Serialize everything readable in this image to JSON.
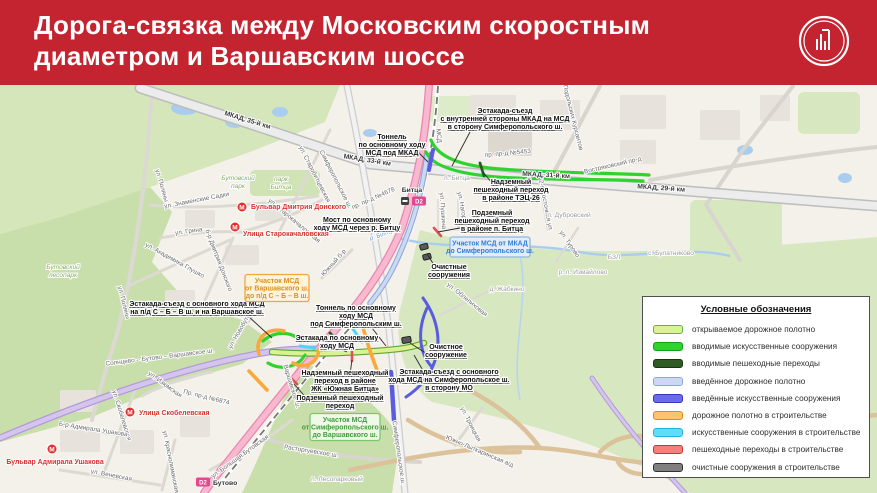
{
  "header": {
    "line1": "Дорога-связка между Московским скоростным",
    "line2": "диаметром и Варшавским шоссе",
    "bg_color": "#c32430",
    "logo": "moscow-construction-complex-logo"
  },
  "legend": {
    "title": "Условные обозначения",
    "items": [
      {
        "label": "открываемое дорожное полотно",
        "fill": "#dcf193",
        "border": "#6ab42d"
      },
      {
        "label": "вводимые искусственные сооружения",
        "fill": "#2ed32e",
        "border": "#14a014"
      },
      {
        "label": "вводимые пешеходные переходы",
        "fill": "#2e5b24",
        "border": "#17350f"
      },
      {
        "label": "введённое дорожное полотно",
        "fill": "#ccd9f2",
        "border": "#8ba6d9"
      },
      {
        "label": "введённые искусственные сооружения",
        "fill": "#6b6bea",
        "border": "#3737bb"
      },
      {
        "label": "дорожное полотно в строительстве",
        "fill": "#fdc46d",
        "border": "#e08a1e"
      },
      {
        "label": "искусственные сооружения в строительстве",
        "fill": "#63dcfb",
        "border": "#1fb4dd"
      },
      {
        "label": "пешеходные переходы в строительстве",
        "fill": "#f57e7e",
        "border": "#cc3333"
      },
      {
        "label": "очистные сооружения в строительстве",
        "fill": "#808080",
        "border": "#333333"
      }
    ]
  },
  "map": {
    "callouts": [
      {
        "ls": [
          "Эстакада-съезд",
          "с внутренней стороны МКАД на МСД",
          "в сторону Симферопольского ш."
        ],
        "x": 505,
        "y": 113,
        "lx": 470,
        "ly": 132,
        "tx": 452,
        "ty": 166
      },
      {
        "ls": [
          "Тоннель",
          "по основному ходу",
          "МСД под МКАД"
        ],
        "x": 392,
        "y": 139,
        "lx": 418,
        "ly": 152,
        "tx": 428,
        "ty": 162
      },
      {
        "ls": [
          "Надземный",
          "пешеходный переход",
          "в районе ТЭЦ-26"
        ],
        "x": 511,
        "y": 184,
        "lx": 492,
        "ly": 183,
        "tx": 483,
        "ty": 172
      },
      {
        "ls": [
          "Мост по основному",
          "ходу МСД через р. Битцу"
        ],
        "x": 357,
        "y": 222,
        "lx": 388,
        "ly": 228,
        "tx": 399,
        "ty": 232
      },
      {
        "ls": [
          "Подземный",
          "пешеходный переход",
          "в районе п. Битца"
        ],
        "x": 492,
        "y": 215,
        "lx": 460,
        "ly": 228,
        "tx": 438,
        "ty": 232
      },
      {
        "ls": [
          "Очистные",
          "сооружения"
        ],
        "x": 449,
        "y": 269,
        "lx": 436,
        "ly": 268,
        "tx": 427,
        "ty": 254
      },
      {
        "ls": [
          "Эстакада-съезд с основного хода МСД",
          "на п/д С – Б – В ш. и на Варшавское ш."
        ],
        "x": 197,
        "y": 306,
        "lx": 248,
        "ly": 316,
        "tx": 272,
        "ty": 338
      },
      {
        "ls": [
          "Тоннель по основному",
          "ходу МСД",
          "под Симферопольским ш."
        ],
        "x": 356,
        "y": 310,
        "lx": 372,
        "ly": 328,
        "tx": 386,
        "ty": 346
      },
      {
        "ls": [
          "Эстакада по основному",
          "ходу МСД"
        ],
        "x": 337,
        "y": 340,
        "lx": 342,
        "ly": 350,
        "tx": 347,
        "ty": 352
      },
      {
        "ls": [
          "Надземный пешеходный",
          "переход в районе",
          "ЖК «Южная Битца»"
        ],
        "x": 345,
        "y": 375,
        "lx": 350,
        "ly": 374,
        "tx": 352,
        "ty": 360
      },
      {
        "ls": [
          "Подземный пешеходный",
          "переход"
        ],
        "x": 340,
        "y": 400,
        "lx": 310,
        "ly": 402,
        "tx": 294,
        "ty": 384
      },
      {
        "ls": [
          "Очистное",
          "сооружение"
        ],
        "x": 446,
        "y": 349,
        "lx": 424,
        "ly": 352,
        "tx": 410,
        "ty": 343
      },
      {
        "ls": [
          "Эстакада-съезд с основного",
          "хода МСД на Симферопольское ш.",
          "в сторону МО"
        ],
        "x": 449,
        "y": 374,
        "lx": 425,
        "ly": 374,
        "tx": 414,
        "ty": 355
      }
    ],
    "boxes": [
      {
        "type": "orange",
        "lines": [
          "Участок МСД",
          "от Варшавского ш.",
          "до п/д С – Б – В ш."
        ],
        "x": 277,
        "y": 288,
        "w": 64,
        "h": 27
      },
      {
        "type": "blue",
        "lines": [
          "Участок МСД от МКАД",
          "до Симферопольского ш."
        ],
        "x": 490,
        "y": 247,
        "w": 80,
        "h": 20
      },
      {
        "type": "green",
        "lines": [
          "Участок МСД",
          "от Симферопольского ш.",
          "до Варшавского ш."
        ],
        "x": 345,
        "y": 427,
        "w": 70,
        "h": 27
      }
    ],
    "labels": [
      {
        "t": "МКАД, 35-й км",
        "x": 247,
        "y": 122,
        "r": 17,
        "c": "mkad"
      },
      {
        "t": "МКАД, 33-й км",
        "x": 367,
        "y": 162,
        "r": 9,
        "c": "mkad"
      },
      {
        "t": "МКАД, 31-й км",
        "x": 546,
        "y": 177,
        "r": 3,
        "c": "mkad"
      },
      {
        "t": "МКАД, 29-й км",
        "x": 661,
        "y": 190,
        "r": 4,
        "c": "mkad"
      },
      {
        "t": "пр. пр-д №5453",
        "x": 508,
        "y": 155,
        "r": -5,
        "c": "st"
      },
      {
        "t": "пр. пр-д №4678",
        "x": 374,
        "y": 200,
        "r": -24,
        "c": "st"
      },
      {
        "t": "Пр. пр-д №6874",
        "x": 206,
        "y": 399,
        "r": 14,
        "c": "st"
      },
      {
        "t": "Востряковский пр-д",
        "x": 613,
        "y": 167,
        "r": -13,
        "c": "st"
      },
      {
        "t": "ул. Подольских Курсантов",
        "x": 570,
        "y": 113,
        "r": 76,
        "c": "st"
      },
      {
        "t": "МСД",
        "x": 437,
        "y": 136,
        "r": 84,
        "c": "st"
      },
      {
        "t": "ул. Пушкина",
        "x": 441,
        "y": 211,
        "r": 86,
        "c": "st"
      },
      {
        "t": "ул. Нагорная",
        "x": 461,
        "y": 211,
        "r": 80,
        "c": "st"
      },
      {
        "t": "Симферопольское ш.",
        "x": 334,
        "y": 180,
        "r": 63,
        "c": "st"
      },
      {
        "t": "Симферопольское ш.",
        "x": 397,
        "y": 453,
        "r": 82,
        "c": "st"
      },
      {
        "t": "Варшавское ш.",
        "x": 290,
        "y": 387,
        "r": 73,
        "c": "st"
      },
      {
        "t": "ул. Новобутовская",
        "x": 245,
        "y": 325,
        "r": -60,
        "c": "st"
      },
      {
        "t": "Солнцево – Бутово – Варшавское ш.",
        "x": 160,
        "y": 359,
        "r": -7,
        "c": "st"
      },
      {
        "t": "ул. Поляны",
        "x": 160,
        "y": 186,
        "r": 74,
        "c": "st"
      },
      {
        "t": "ул. Поляны",
        "x": 122,
        "y": 303,
        "r": 76,
        "c": "st"
      },
      {
        "t": "ул. Знаменские Садки",
        "x": 197,
        "y": 202,
        "r": -11,
        "c": "st"
      },
      {
        "t": "ул. Старобитцевская",
        "x": 313,
        "y": 175,
        "r": 63,
        "c": "st"
      },
      {
        "t": "ул. Старокачаловская",
        "x": 293,
        "y": 222,
        "r": 40,
        "c": "st"
      },
      {
        "t": "ул. Грина",
        "x": 189,
        "y": 233,
        "r": -8,
        "c": "st"
      },
      {
        "t": "ул. Академика Глушко",
        "x": 174,
        "y": 262,
        "r": 29,
        "c": "st"
      },
      {
        "t": "б-р Дмитрия Донского",
        "x": 217,
        "y": 261,
        "r": 69,
        "c": "st"
      },
      {
        "t": "Южный б-р",
        "x": 335,
        "y": 264,
        "r": -48,
        "c": "st"
      },
      {
        "t": "ул. Скобелевская",
        "x": 120,
        "y": 416,
        "r": 73,
        "c": "st"
      },
      {
        "t": "Б-р Адмирала Ушакова",
        "x": 93,
        "y": 431,
        "r": 9,
        "c": "st"
      },
      {
        "t": "ул. Веневская",
        "x": 111,
        "y": 477,
        "r": 11,
        "c": "st"
      },
      {
        "t": "ул. Краснолиманская",
        "x": 169,
        "y": 462,
        "r": 79,
        "c": "st"
      },
      {
        "t": "ул. Большая Бутовская",
        "x": 241,
        "y": 458,
        "r": -36,
        "c": "st"
      },
      {
        "t": "ул. Изюмская",
        "x": 164,
        "y": 386,
        "r": 36,
        "c": "st"
      },
      {
        "t": "Расторгуевское ш.",
        "x": 311,
        "y": 453,
        "r": 9,
        "c": "st"
      },
      {
        "t": "ул. Троицкая",
        "x": 469,
        "y": 425,
        "r": 63,
        "c": "st"
      },
      {
        "t": "Южно-Лыткаринская а/д",
        "x": 479,
        "y": 453,
        "r": 23,
        "c": "st"
      },
      {
        "t": "ул. Облепиховая",
        "x": 466,
        "y": 301,
        "r": 39,
        "c": "st"
      },
      {
        "t": "ул. Турово",
        "x": 568,
        "y": 245,
        "r": 56,
        "c": "st"
      },
      {
        "t": "2-я Восточная ул.",
        "x": 544,
        "y": 206,
        "r": 79,
        "c": "st"
      },
      {
        "t": "п. Битца",
        "x": 457,
        "y": 180,
        "c": "set"
      },
      {
        "t": "п. Дубровский",
        "x": 569,
        "y": 217,
        "c": "set"
      },
      {
        "t": "д. Жабкино",
        "x": 507,
        "y": 291,
        "c": "set"
      },
      {
        "t": "р. п. Измайлово",
        "x": 583,
        "y": 274,
        "c": "set"
      },
      {
        "t": "с. Булатниково",
        "x": 671,
        "y": 255,
        "c": "set"
      },
      {
        "t": "БЗЛ",
        "x": 614,
        "y": 259,
        "c": "set"
      },
      {
        "t": "п. Лесопарковый",
        "x": 337,
        "y": 481,
        "c": "set"
      },
      {
        "t": "Бутовский",
        "x": 63,
        "y": 269,
        "c": "park"
      },
      {
        "t": "лесопарк",
        "x": 63,
        "y": 277,
        "c": "park"
      },
      {
        "t": "Бутовский",
        "x": 238,
        "y": 180,
        "c": "park"
      },
      {
        "t": "парк",
        "x": 238,
        "y": 188,
        "c": "park"
      },
      {
        "t": "парк",
        "x": 281,
        "y": 181,
        "c": "park"
      },
      {
        "t": "Битца",
        "x": 281,
        "y": 189,
        "c": "park"
      },
      {
        "t": "р. Битца",
        "x": 383,
        "y": 236,
        "r": -20,
        "c": "wat"
      }
    ],
    "metro": [
      {
        "label": "Бульвар Дмитрия Донского",
        "ix": 242,
        "iy": 207,
        "lx": 251,
        "ly": 209,
        "anchor": "start"
      },
      {
        "label": "Улица Старокачаловская",
        "ix": 235,
        "iy": 227,
        "lx": 243,
        "ly": 236,
        "anchor": "start"
      },
      {
        "label": "Улица Скобелевская",
        "ix": 130,
        "iy": 412,
        "lx": 139,
        "ly": 415,
        "anchor": "start"
      },
      {
        "label": "Бульвар Адмирала Ушакова",
        "ix": 52,
        "iy": 449,
        "lx": 55,
        "ly": 464,
        "anchor": "middle"
      }
    ],
    "d2_stations": [
      {
        "badge": "D2",
        "name": "Битца",
        "bx": 419,
        "by": 201,
        "sx": 405,
        "sy": 201,
        "nx": 412,
        "ny": 192,
        "anchor": "middle"
      },
      {
        "badge": "D2",
        "name": "Бутово",
        "bx": 203,
        "by": 482,
        "sx": -100,
        "sy": -100,
        "nx": 213,
        "ny": 485,
        "anchor": "start"
      }
    ],
    "box_colors": {
      "orange": {
        "bg": "#fdf4dd",
        "border": "#efa73e",
        "text": "#dd8f1c"
      },
      "blue": {
        "bg": "#e2edf9",
        "border": "#8fb6e0",
        "text": "#2f7ed8"
      },
      "green": {
        "bg": "#eef9e8",
        "border": "#7cc76a",
        "text": "#3f9e38"
      }
    }
  }
}
